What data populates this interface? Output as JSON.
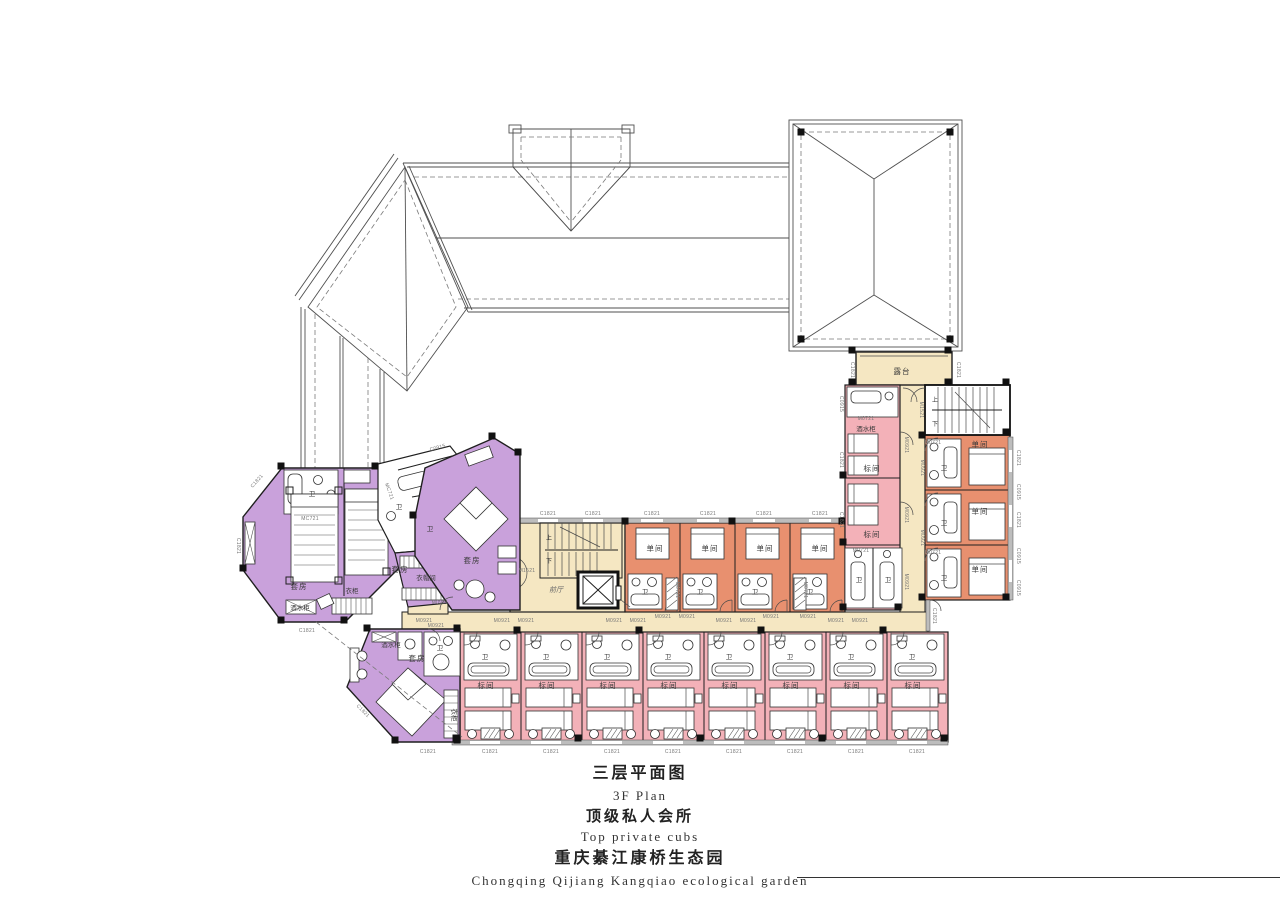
{
  "title_block": {
    "floor_zh": "三层平面图",
    "floor_en": "3F Plan",
    "club_zh": "顶级私人会所",
    "club_en": "Top private cubs",
    "project_zh": "重庆綦江康桥生态园",
    "project_en": "Chongqing Qijiang Kangqiao ecological garden"
  },
  "plan": {
    "labels": {
      "terrace": "露台",
      "front_hall": "前厅",
      "single_room": "单间",
      "standard_room": "标间",
      "suite": "套房",
      "bath": "卫",
      "wine_cabinet": "酒水柜",
      "wardrobe": "衣柜",
      "cloakroom": "衣帽间",
      "up": "上",
      "down": "下"
    },
    "codes": {
      "window_l": "C1821",
      "window_s": "C0915",
      "door_std": "M0921",
      "door_bath": "M0721",
      "door_suite": "MC721",
      "door_main": "M1521"
    },
    "colors": {
      "corridor": "#F5E7C2",
      "standard_room": "#F3B1B8",
      "single_room": "#E8906F",
      "suite": "#C9A1DB",
      "wall": "#1a1a1a",
      "window_wall": "#bdbdbd",
      "roof_line": "#4f4f4f"
    }
  }
}
